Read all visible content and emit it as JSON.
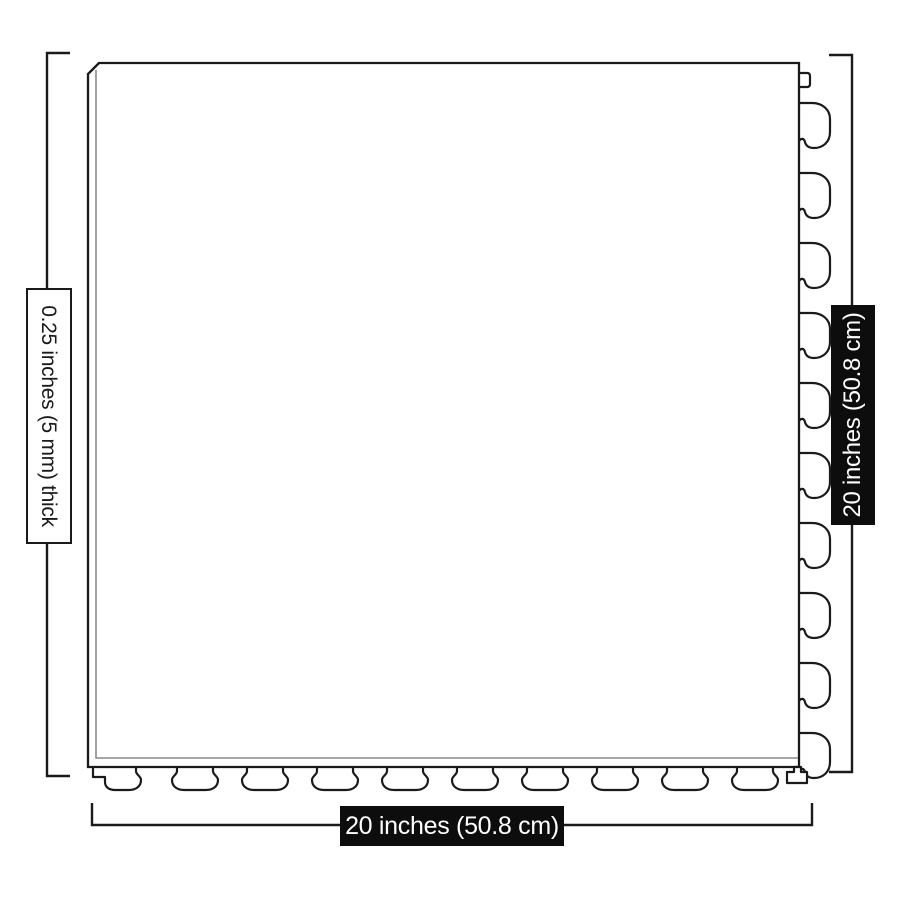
{
  "labels": {
    "thickness": "0.25 inches (5 mm) thick",
    "height": "20 inches (50.8 cm)",
    "width": "20 inches (50.8 cm)"
  },
  "colors": {
    "background": "#ffffff",
    "line": "#1a1a1a",
    "inner_edge_line": "#8a8a8a",
    "dark_label_background": "#0d0d0d",
    "dark_label_text": "#ffffff",
    "light_label_background": "#ffffff",
    "light_label_border": "#1a1a1a",
    "light_label_text": "#1a1a1a"
  }
}
